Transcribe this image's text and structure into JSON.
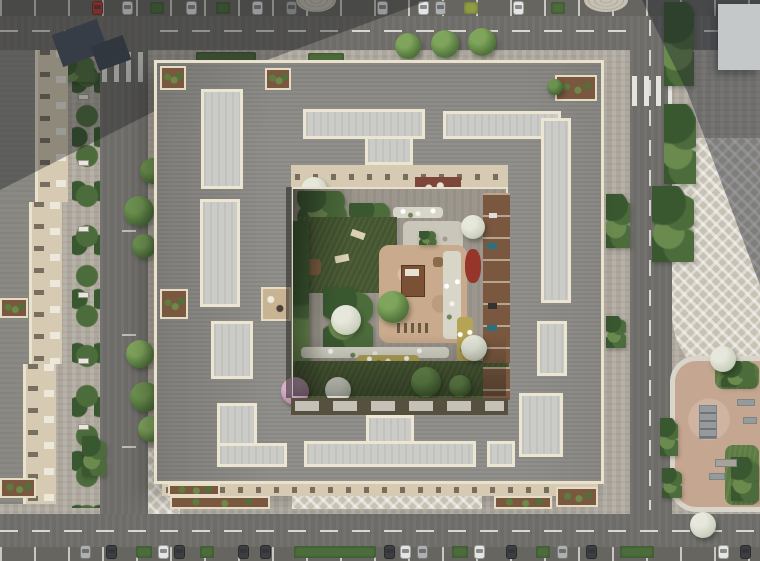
{
  "meta": {
    "title": "Aerial render of residential perimeter block",
    "aria_label": "Top-down aerial architectural rendering of a residential perimeter block with a landscaped inner courtyard, surrounding streets with parked cars, street trees, two zebra crosswalks, a neighboring building to the west, a light tower roof to the northeast and a tan playground park to the southeast"
  },
  "palette": {
    "pavement": "#b3ada3",
    "pavement_shadow": "#5a6069",
    "road": "#716f6b",
    "road_line": "#d8d7d2",
    "roof_gray": "#8d8c88",
    "roof_light_panel": "#cbccc7",
    "parapet_cream": "#eae2cd",
    "facade_beige": "#d6cbb2",
    "lawn_dark": "#44552f",
    "grass": "#5d7c43",
    "bush": "#4c6c3c",
    "bush_light": "#6a8a4e",
    "bush_dark": "#3a5830",
    "sand": "#c9aa8c",
    "park_tan": "#c5a791",
    "terrace_brown": "#7a573f",
    "flower_white": "#d8d6c9",
    "flower_yellow": "#b5a455",
    "bush_red": "#96352a",
    "tree_pink": "#b98ba9",
    "tree_white": "#d0d3c3",
    "car_white": "#e5e6e3",
    "car_red": "#b63b32",
    "car_dark": "#3c3e40",
    "car_silver": "#aeb0ae",
    "tower_roof": "#c4c8c8"
  },
  "inventory": {
    "buildings": [
      "main-perimeter-block",
      "neighbor-block-west",
      "tower-northeast"
    ],
    "cars_top_row": 9,
    "cars_bottom_row": 15,
    "hedge_planters_top": 4,
    "hedge_planters_bottom": 6,
    "crosswalks": 2,
    "street_trees": 9,
    "roof_light_panels": 14,
    "roof_terraces": 6,
    "courtyard_features": [
      "dark-lawn-with-loungers",
      "sand-playground",
      "play-structure",
      "bench-row",
      "flower-beds",
      "red-shrub",
      "gravel-path",
      "private-terraces",
      "flowering-trees"
    ],
    "park_features": [
      "skate-ramp",
      "rails",
      "bench",
      "grass-islands",
      "shrubs"
    ]
  }
}
